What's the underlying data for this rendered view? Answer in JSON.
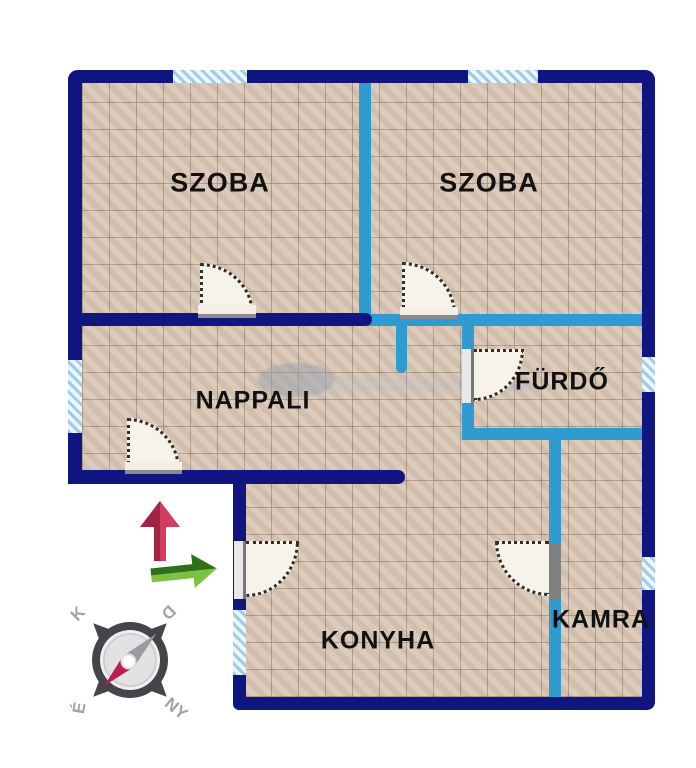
{
  "rooms": {
    "szoba_left": {
      "label": "SZOBA"
    },
    "szoba_right": {
      "label": "SZOBA"
    },
    "nappali": {
      "label": "NAPPALI"
    },
    "furdo": {
      "label": "FÜRDŐ"
    },
    "konyha": {
      "label": "KONYHA"
    },
    "kamra": {
      "label": "KAMRA"
    }
  },
  "compass": {
    "north": "É",
    "south": "D",
    "east": "K",
    "west": "NY"
  },
  "colors": {
    "exterior_wall": "#101580",
    "interior_wall": "#2f9bd0",
    "window_fill": "#aed3ea",
    "floor_tile": "#d8c5b3",
    "door_fill": "#f8f3ea",
    "north_arrow_red": "#d23c5e",
    "orientation_arrow_green": "#7cc143",
    "compass_needle_red": "#c01d56",
    "compass_needle_gray": "#9a9aa0"
  }
}
